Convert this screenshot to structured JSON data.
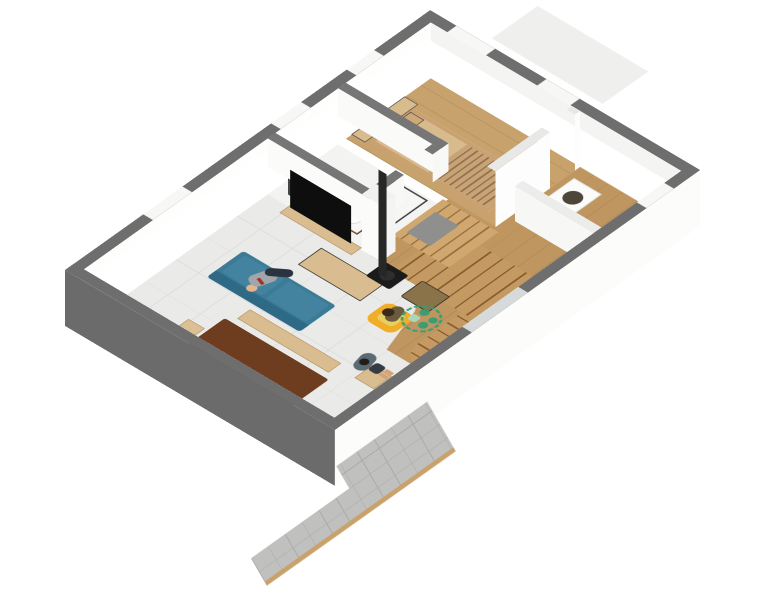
{
  "scene": {
    "type": "3d-floor-plan-render",
    "view": "axonometric dollhouse cutaway, rotated",
    "background": "#ffffff",
    "visible_text": "none"
  },
  "watermark": {
    "description": "green dashed circle badge with dots, on hallway floor",
    "color": "#2f9e74"
  },
  "palette": {
    "wall_gray": "#6e6e6e",
    "interior_wall_gray": "#767676",
    "wall_face_white": "#fcfcfb",
    "floor_tile": "#eaeae8",
    "bathroom_floor": "#f3f3f1",
    "bedroom_wood": "#c7a26c",
    "hall_wood": "#bf9660",
    "stair_wood": "#b9894f",
    "terrace_tile": "#c0c0be",
    "terrace_edge": "#c9a26b",
    "sofa_teal": "#3b7b96",
    "armchair_yellow": "#f0ad28",
    "sling_tan": "#8a7348",
    "dining_walnut": "#6e3c1e",
    "light_wood": "#d9bc90",
    "stove_black": "#1b1b1b",
    "tv_black": "#0e0e0e",
    "mirror_gray": "#454545",
    "vanity_wood": "#6f4b31",
    "doormat_gray": "#a3a3a1",
    "skin": "#e0ac80",
    "shirt_gray": "#a2a6aa",
    "pants_navy": "#2c3340",
    "watermark_green": "#2f9e74"
  },
  "rooms": [
    {
      "name": "living-dining-room",
      "floor": "light gray tile"
    },
    {
      "name": "bathroom",
      "floor": "white"
    },
    {
      "name": "bedroom",
      "floor": "wood"
    },
    {
      "name": "hallway-stairs",
      "floor": "wood, winding staircase"
    },
    {
      "name": "entry",
      "floor": "wood with gray doormat"
    },
    {
      "name": "terrace",
      "floor": "gray tile with tan edge"
    }
  ],
  "furniture": {
    "living": [
      "dark walnut dining table",
      "3 side chairs",
      "head chair",
      "wood bench",
      "side stool",
      "teal 3-seat sofa",
      "light-wood coffee table",
      "yellow armchair",
      "tan sling chair",
      "TV media bench",
      "flat-screen TV",
      "black wood stove with chimney pipe"
    ],
    "bathroom": [
      "dark mirror panel",
      "wood vanity with round basin",
      "glass shower with round head"
    ],
    "bedroom": [
      "slatted wood bed",
      "clothes rack with shelf",
      "mid shelf"
    ],
    "entry": [
      "white basin cabinet with dark round bowl",
      "doormat",
      "bath mat"
    ]
  },
  "people": [
    {
      "location": "sofa",
      "pose": "reclined sitting",
      "clothes": "gray shirt, navy pants"
    },
    {
      "location": "yellow-armchair",
      "pose": "sitting, hands behind head"
    },
    {
      "location": "living-room-floor",
      "pose": "standing",
      "clothes": "gray-blue tee, dark shorts"
    }
  ]
}
